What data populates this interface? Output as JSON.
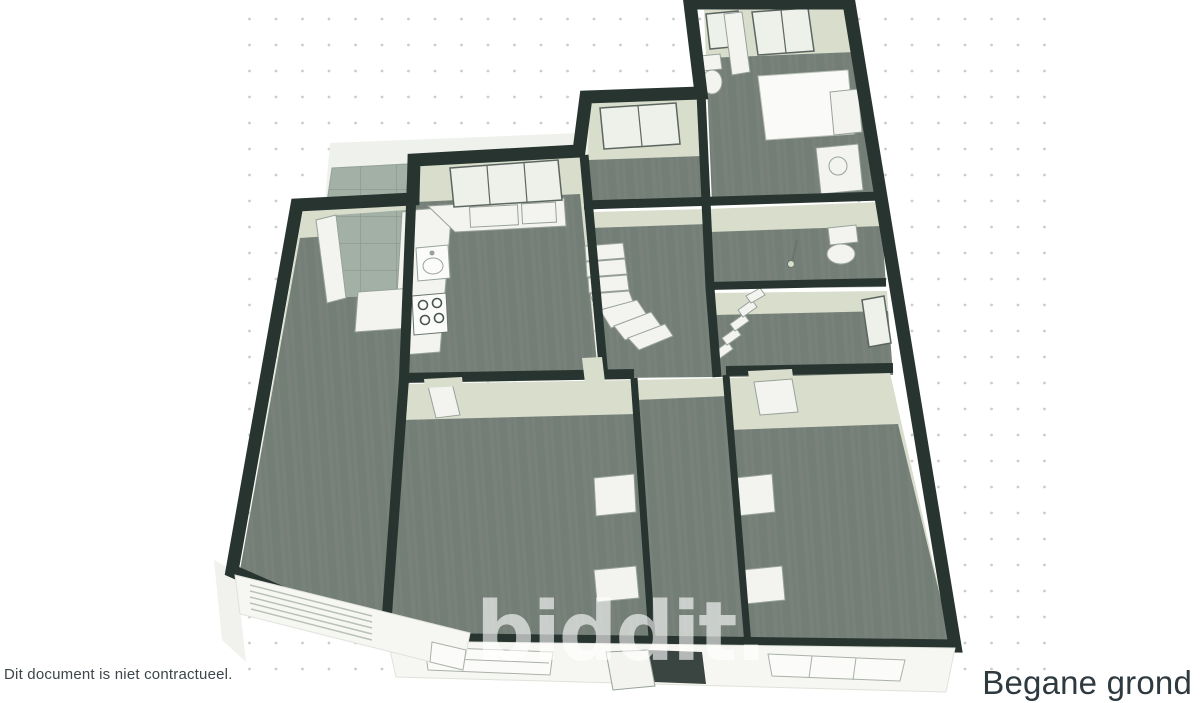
{
  "texts": {
    "disclaimer": "Dit document is niet contractueel.",
    "floor_title": "Begane grond",
    "watermark": "biddit."
  },
  "floorplan": {
    "view": "3d-isometric-floorplan",
    "floor_name": "Begane grond"
  },
  "colors": {
    "background": "#ffffff",
    "dot_grid": "#cccccc",
    "wall_dark": "#273430",
    "wall_light": "#d8ddcc",
    "floor": "#78827b",
    "floor_streak": "#6f7973",
    "tile": "#a3b0a6",
    "tile_line": "#8c9a90",
    "furniture_white": "#f3f4f0",
    "furniture_outline": "#98a29a",
    "elevation_face": "#f6f7f3",
    "watermark_white": "rgba(255,255,255,0.62)",
    "disclaimer_text": "#3d464a",
    "title_text": "#2e3a40"
  }
}
